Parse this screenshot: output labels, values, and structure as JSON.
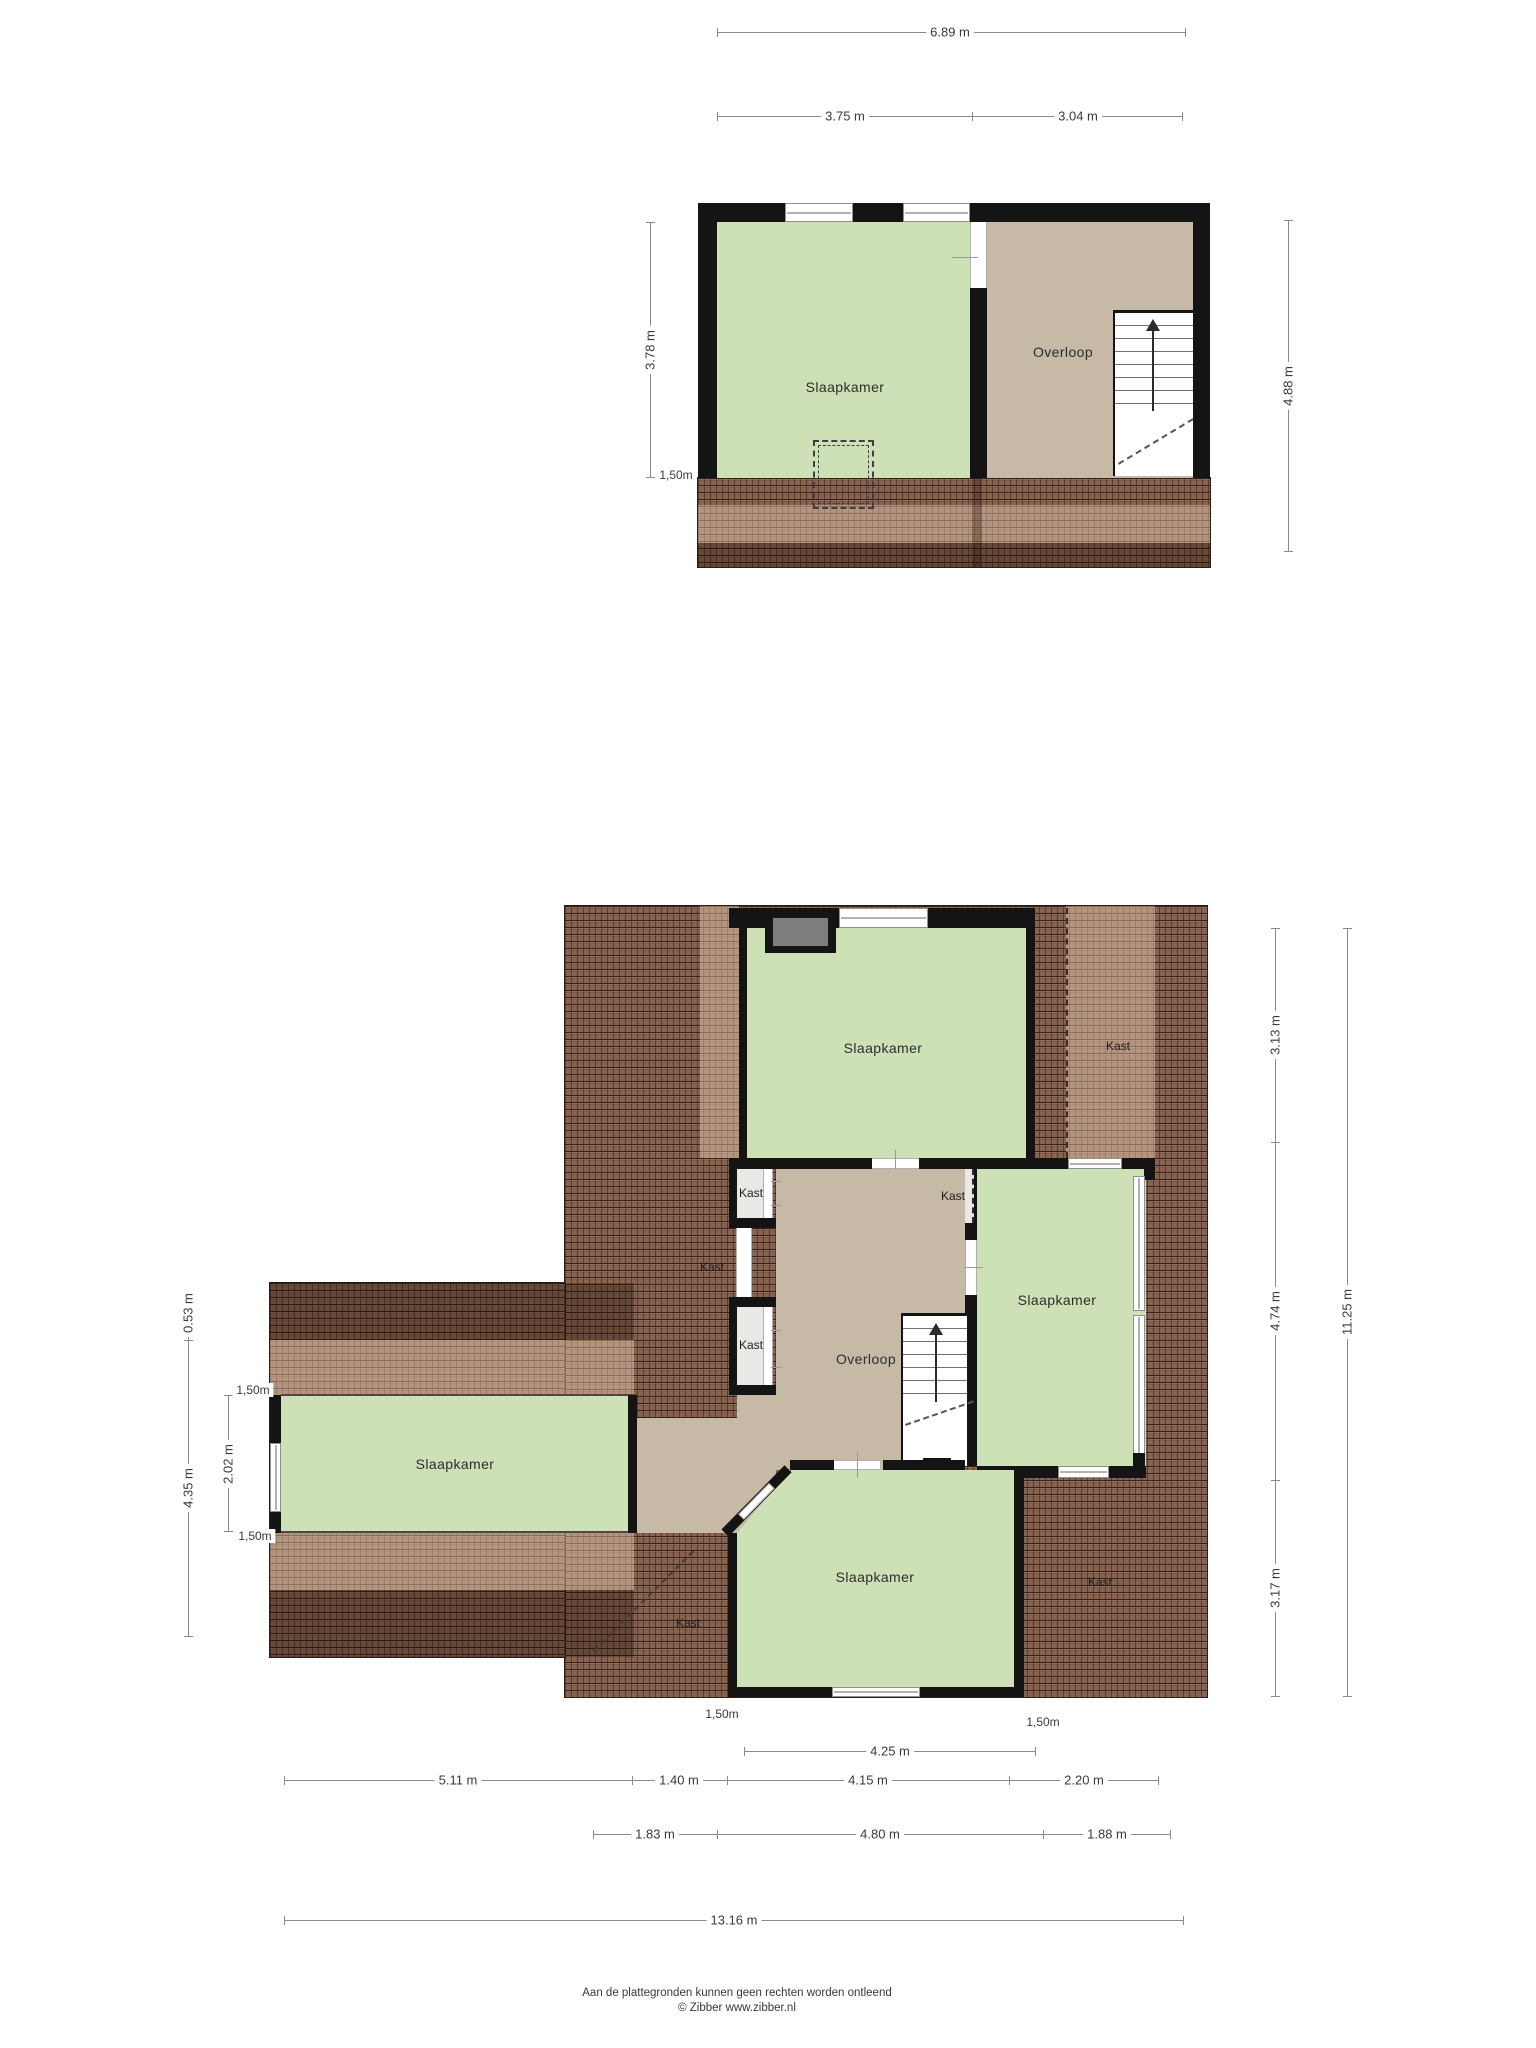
{
  "colors": {
    "room_green": "#cde0b6",
    "landing_tan": "#c6b9a6",
    "closet_gray": "#e9e8e4",
    "wall_black": "#141414",
    "tile_brown": "#8a6350"
  },
  "floor_top": {
    "rooms": {
      "bedroom": "Slaapkamer",
      "landing": "Overloop"
    },
    "dims": {
      "total_width": "6.89 m",
      "width_left": "3.75 m",
      "width_right": "3.04 m",
      "height_left": "3.78 m",
      "attic_left": "1,50m",
      "height_right": "4.88 m"
    }
  },
  "floor_main": {
    "rooms": {
      "bedroom_top": "Slaapkamer",
      "bedroom_right": "Slaapkamer",
      "bedroom_left": "Slaapkamer",
      "bedroom_bottom": "Slaapkamer",
      "landing": "Overloop",
      "closet_top_right": "Kast",
      "closet_left_upper": "Kast",
      "closet_left_mid": "Kast",
      "closet_left_lower": "Kast",
      "closet_right_small": "Kast",
      "closet_bottom_right": "Kast",
      "closet_bottom_left": "Kast"
    },
    "dims": {
      "right_top": "3.13 m",
      "right_mid": "4.74 m",
      "right_bottom": "3.17 m",
      "right_total": "11.25 m",
      "left_offset": "0.53 m",
      "left_total": "4.35 m",
      "left_150_top": "1,50m",
      "left_width": "2.02 m",
      "left_150_bottom": "1,50m",
      "bottom_150_left": "1,50m",
      "bottom_150_right": "1,50m",
      "bottom_row1": "4.25 m",
      "bottom_row2_1": "5.11 m",
      "bottom_row2_2": "1.40 m",
      "bottom_row2_3": "4.15 m",
      "bottom_row2_4": "2.20 m",
      "bottom_row3_1": "1.83 m",
      "bottom_row3_2": "4.80 m",
      "bottom_row3_3": "1.88 m",
      "bottom_total": "13.16 m"
    }
  },
  "footer": {
    "line1": "Aan de plattegronden kunnen geen rechten worden ontleend",
    "line2": "© Zibber www.zibber.nl"
  }
}
